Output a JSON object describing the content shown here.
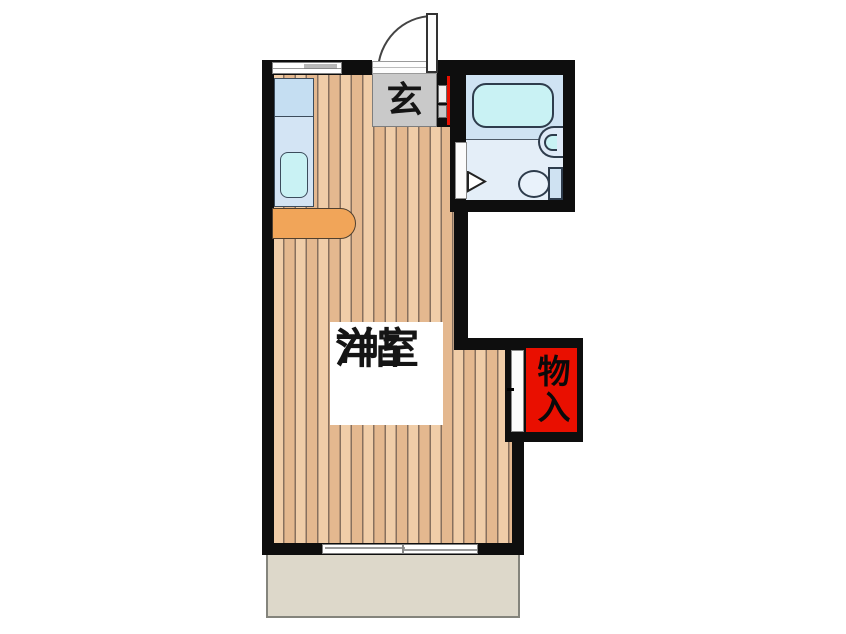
{
  "floorplan": {
    "type": "japanese-apartment-floorplan",
    "rooms": {
      "main_room": {
        "name": "洋室",
        "size": "7帖"
      },
      "entrance": {
        "label": "玄"
      },
      "storage": {
        "label": "物入"
      }
    },
    "fixtures": {
      "entrance_door": "swing-door-icon",
      "bathtub": "bathtub-icon",
      "washbasin": "washbasin-icon",
      "toilet": "toilet-icon",
      "bathroom_door": "door-swing-triangle-icon",
      "kitchen_sink": "kitchen-sink-icon",
      "kitchen_counter": "counter-icon",
      "storage_door": "sliding-door-icon",
      "windows": "sliding-window-icon",
      "balcony": "balcony-area"
    },
    "colors": {
      "wall": "#0e0e0e",
      "red": "#e90f00",
      "entrance_gray": "#c9c9c9",
      "floor_light": "#f0cda8",
      "floor_dark": "#e4b88f",
      "floor_line": "#87705e",
      "cyan": "#c9f2f4",
      "bath_upper": "#cfe3f3",
      "bath_lower": "#e4eef8",
      "kitchen_1": "#c5def2",
      "kitchen_2": "#d3e4f4",
      "orange": "#f1a559",
      "balcony": "#ddd8ca"
    }
  }
}
